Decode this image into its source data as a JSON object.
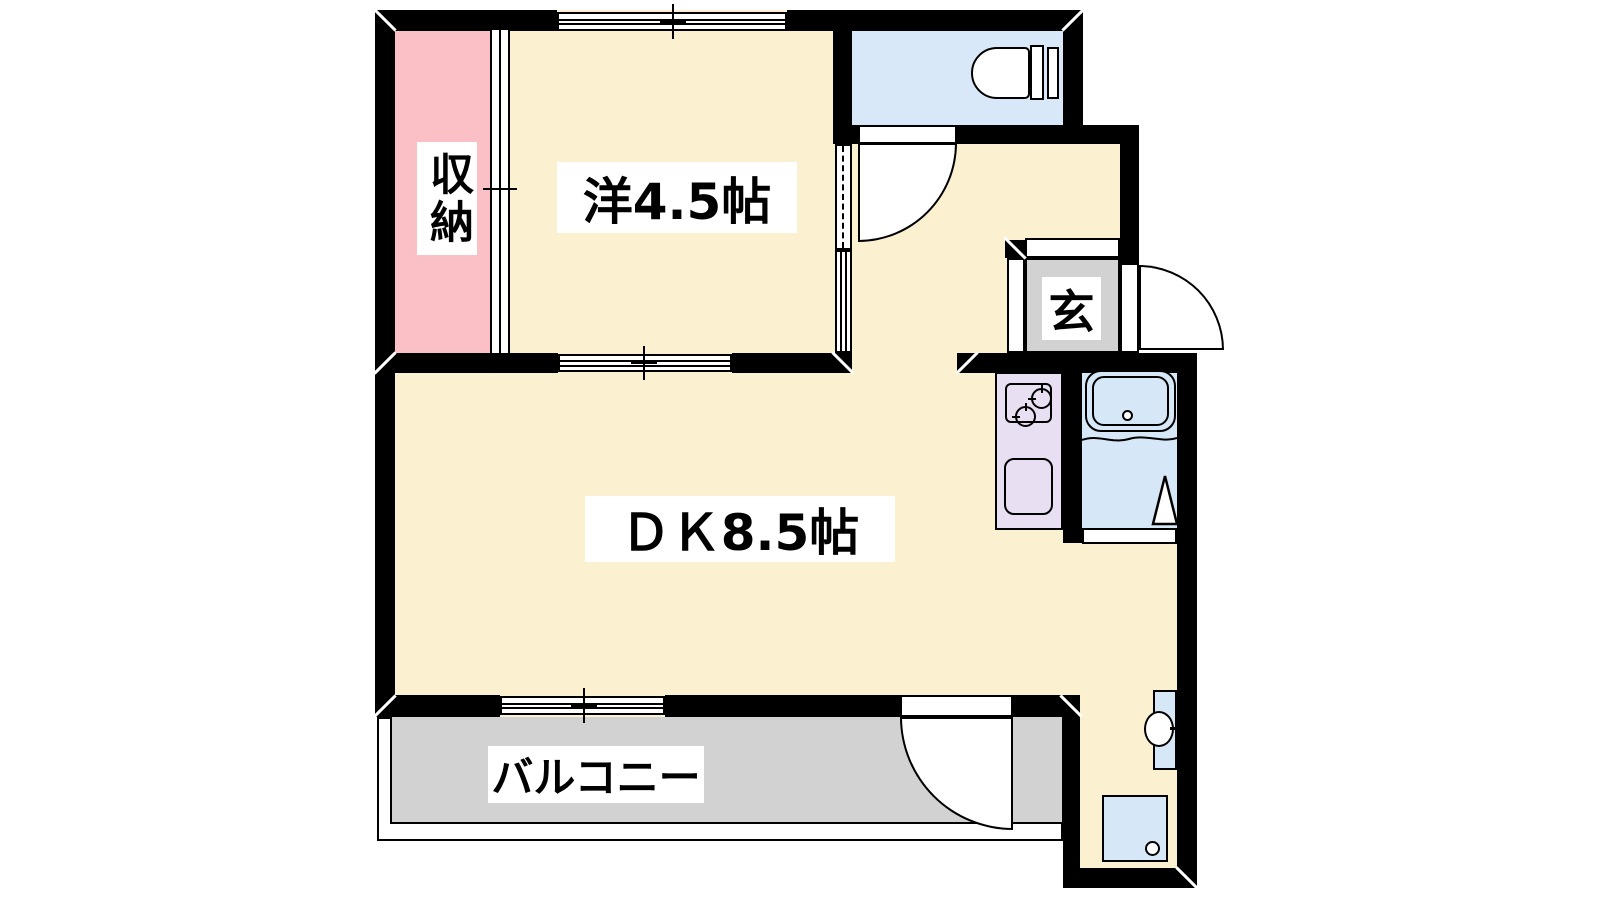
{
  "floorplan": {
    "rooms": {
      "closet": {
        "label": "収納"
      },
      "western_room": {
        "label": "洋4.5帖"
      },
      "dining_kitchen": {
        "label": "ＤＫ8.5帖"
      },
      "entrance": {
        "label": "玄"
      },
      "balcony": {
        "label": "バルコニー"
      }
    },
    "colors": {
      "wall": "#000000",
      "floor": "#FBF0D0",
      "closet": "#FBC0C5",
      "toilet_room": "#D9E8F8",
      "bathroom": "#D6E7F8",
      "kitchen_counter": "#E9DFF2",
      "entrance_floor": "#D2D2D2",
      "balcony_floor": "#D2D2D2"
    },
    "fixtures": {
      "toilet": "toilet-icon",
      "stove": "two-burner-stove-icon",
      "kitchen_sink": "kitchen-sink-icon",
      "bathtub": "bathtub-icon",
      "washbasin": "washbasin-icon",
      "washer_pan": "washing-machine-pan-icon"
    }
  }
}
